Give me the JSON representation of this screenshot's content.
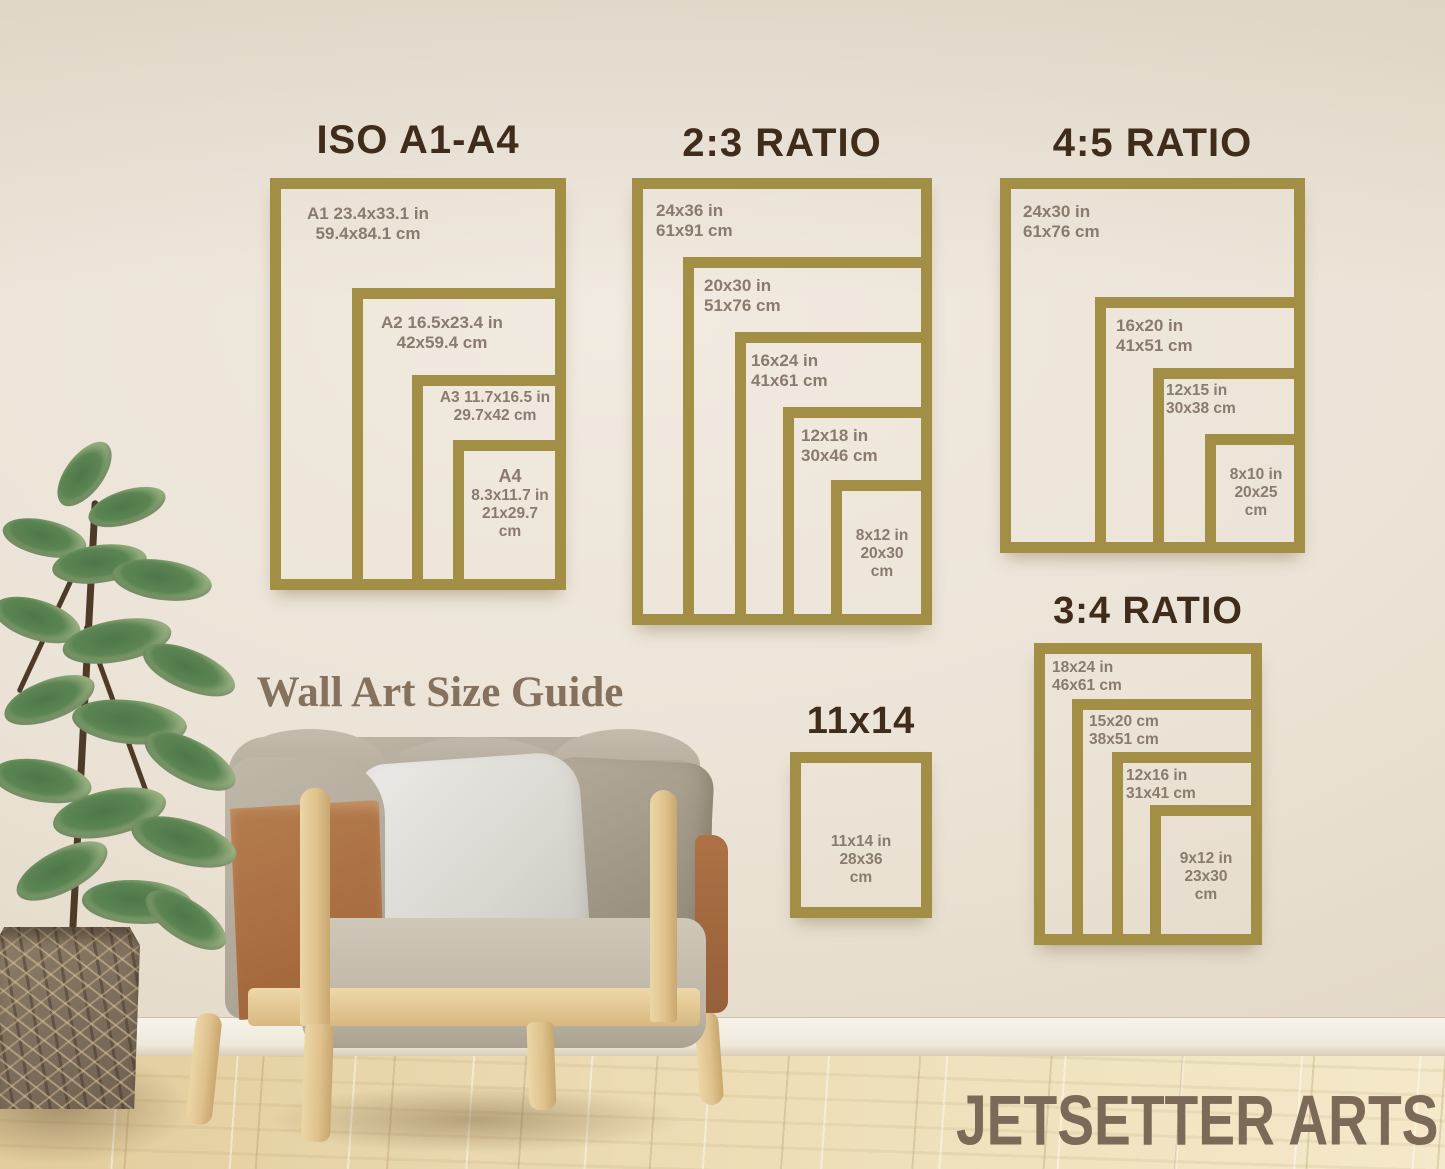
{
  "guide": {
    "caption": "Wall Art Size Guide"
  },
  "brand": {
    "name": "JETSETTER ARTS"
  },
  "sections": {
    "iso": {
      "title": "ISO A1-A4",
      "frames": [
        {
          "name": "A1",
          "lines": [
            "A1 23.4x33.1 in",
            "59.4x84.1 cm"
          ]
        },
        {
          "name": "A2",
          "lines": [
            "A2 16.5x23.4 in",
            "42x59.4 cm"
          ]
        },
        {
          "name": "A3",
          "lines": [
            "A3 11.7x16.5 in",
            "29.7x42 cm"
          ]
        },
        {
          "name": "A4",
          "lines": [
            "A4",
            "8.3x11.7 in",
            "21x29.7",
            "cm"
          ]
        }
      ]
    },
    "r23": {
      "title": "2:3 RATIO",
      "frames": [
        {
          "name": "24x36",
          "lines": [
            "24x36 in",
            "61x91 cm"
          ]
        },
        {
          "name": "20x30",
          "lines": [
            "20x30 in",
            "51x76 cm"
          ]
        },
        {
          "name": "16x24",
          "lines": [
            "16x24 in",
            "41x61 cm"
          ]
        },
        {
          "name": "12x18",
          "lines": [
            "12x18 in",
            "30x46 cm"
          ]
        },
        {
          "name": "8x12",
          "lines": [
            "8x12 in",
            "20x30",
            "cm"
          ]
        }
      ]
    },
    "r45": {
      "title": "4:5 RATIO",
      "frames": [
        {
          "name": "24x30",
          "lines": [
            "24x30 in",
            "61x76 cm"
          ]
        },
        {
          "name": "16x20",
          "lines": [
            "16x20 in",
            "41x51 cm"
          ]
        },
        {
          "name": "12x15",
          "lines": [
            "12x15 in",
            "30x38 cm"
          ]
        },
        {
          "name": "8x10",
          "lines": [
            "8x10 in",
            "20x25",
            "cm"
          ]
        }
      ]
    },
    "r34": {
      "title": "3:4 RATIO",
      "frames": [
        {
          "name": "18x24",
          "lines": [
            "18x24 in",
            "46x61 cm"
          ]
        },
        {
          "name": "15x20",
          "lines": [
            "15x20 cm",
            "38x51 cm"
          ]
        },
        {
          "name": "12x16",
          "lines": [
            "12x16 in",
            "31x41 cm"
          ]
        },
        {
          "name": "9x12",
          "lines": [
            "9x12 in",
            "23x30",
            "cm"
          ]
        }
      ]
    },
    "s1114": {
      "title": "11x14",
      "frames": [
        {
          "name": "11x14",
          "lines": [
            "11x14 in",
            "28x36",
            "cm"
          ]
        }
      ]
    }
  },
  "colors": {
    "frame_gold": "#a28f45",
    "title_brown": "#3f2c1b",
    "label_gray": "#897b6d",
    "serif_brown": "#84715e",
    "brand_brown": "#7b6a57"
  }
}
